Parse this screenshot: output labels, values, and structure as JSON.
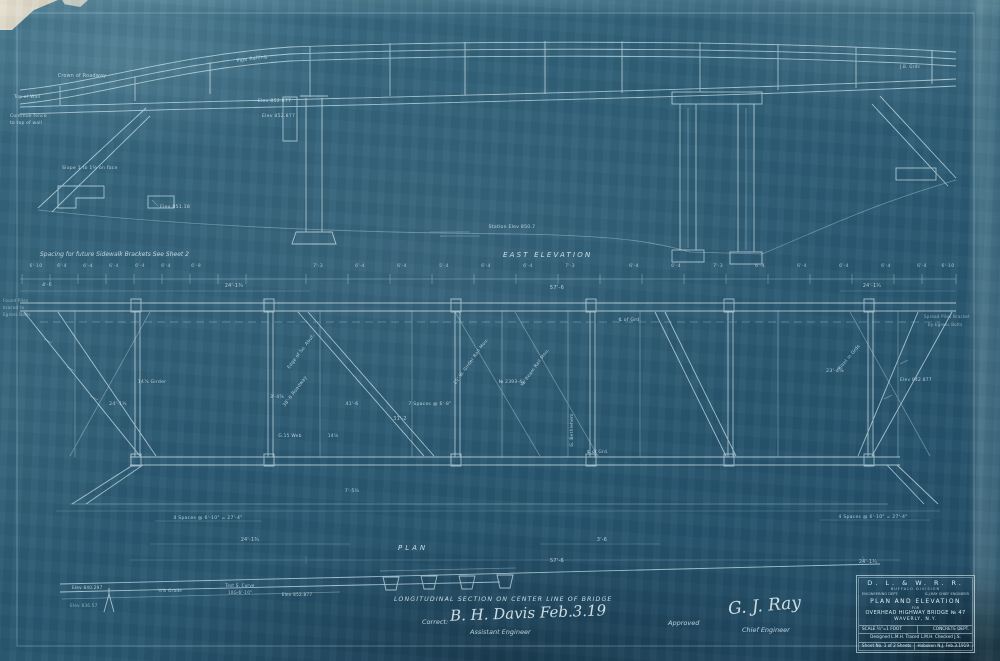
{
  "sheet": {
    "headings": {
      "elevation": "EAST ELEVATION",
      "plan": "PLAN",
      "section": "LONGITUDINAL SECTION ON CENTER LINE OF BRIDGE"
    },
    "notes": {
      "sidewalk": "Spacing for future Sidewalk Brackets   See Sheet 2"
    },
    "signatures": {
      "correct_label": "Correct:",
      "correct_sig": "B. H. Davis  Feb.3.19",
      "correct_title": "Assistant Engineer",
      "approved_label": "Approved",
      "approved_sig": "G. J. Ray",
      "approved_title": "Chief Engineer"
    },
    "title_block": {
      "railroad": "D. L. & W. R. R.",
      "division": "BUFFALO DIVISION",
      "dept": "ENGINEERING DEPT.",
      "chief": "G.J.RAY CHIEF ENGINEER",
      "title1": "PLAN AND ELEVATION",
      "for_word": "FOR",
      "title2": "OVERHEAD HIGHWAY BRIDGE № 47",
      "location": "WAVERLY, N.Y.",
      "scale": "SCALE ¼\"=1 FOOT",
      "dept2": "CONCRETE DEPT.",
      "designed": "Designed L.M.H.  Traced L.M.H.  Checked J.S.",
      "sheet_no": "Sheet No. 1 of 2 Sheets",
      "place_date": "Hoboken N.J. Feb.3.1919"
    },
    "colors": {
      "paper": "#2b5a73",
      "line": "#d6edf3"
    }
  },
  "labels": [
    {
      "x": 82,
      "y": 77,
      "t": "Crown of Roadway",
      "s": 4.8
    },
    {
      "x": 252,
      "y": 60,
      "t": "Pipe Railing",
      "s": 4.8,
      "r": -8
    },
    {
      "x": 910,
      "y": 68,
      "t": "J.B. Grds",
      "s": 4.2
    },
    {
      "x": 14,
      "y": 98,
      "t": "Top of Wall",
      "s": 4.4,
      "a": "start"
    },
    {
      "x": 10,
      "y": 117,
      "t": "Continue fence",
      "s": 4.4,
      "a": "start"
    },
    {
      "x": 10,
      "y": 124,
      "t": "to top of wall",
      "s": 4.4,
      "a": "start"
    },
    {
      "x": 258,
      "y": 102,
      "t": "Elev 852.877",
      "s": 4.6,
      "a": "start"
    },
    {
      "x": 262,
      "y": 117,
      "t": "Elev 852.877",
      "s": 4.6,
      "a": "start"
    },
    {
      "x": 62,
      "y": 169,
      "t": "Slope 1 to 1½ on face",
      "s": 4.6,
      "a": "start"
    },
    {
      "x": 160,
      "y": 208,
      "t": "Elev 851.18",
      "s": 4.6,
      "a": "start"
    },
    {
      "x": 512,
      "y": 228,
      "t": "Station Elev 850.7",
      "s": 4.6
    },
    {
      "x": 36,
      "y": 267,
      "t": "6'-10",
      "s": 4.6,
      "o": 0.7
    },
    {
      "x": 62,
      "y": 267,
      "t": "6'-4",
      "s": 4.6,
      "o": 0.7
    },
    {
      "x": 88,
      "y": 267,
      "t": "6'-4",
      "s": 4.6,
      "o": 0.7
    },
    {
      "x": 114,
      "y": 267,
      "t": "6'-4",
      "s": 4.6,
      "o": 0.7
    },
    {
      "x": 140,
      "y": 267,
      "t": "6'-4",
      "s": 4.6,
      "o": 0.7
    },
    {
      "x": 166,
      "y": 267,
      "t": "6'-4",
      "s": 4.6,
      "o": 0.7
    },
    {
      "x": 196,
      "y": 267,
      "t": "6'-9",
      "s": 4.6,
      "o": 0.7
    },
    {
      "x": 318,
      "y": 267,
      "t": "7'-3",
      "s": 4.6,
      "o": 0.7
    },
    {
      "x": 360,
      "y": 267,
      "t": "6'-4",
      "s": 4.6,
      "o": 0.7
    },
    {
      "x": 402,
      "y": 267,
      "t": "6'-4",
      "s": 4.6,
      "o": 0.7
    },
    {
      "x": 444,
      "y": 267,
      "t": "5'-4",
      "s": 4.6,
      "o": 0.7
    },
    {
      "x": 486,
      "y": 267,
      "t": "6'-4",
      "s": 4.6,
      "o": 0.7
    },
    {
      "x": 528,
      "y": 267,
      "t": "6'-4",
      "s": 4.6,
      "o": 0.7
    },
    {
      "x": 570,
      "y": 267,
      "t": "7'-3",
      "s": 4.6,
      "o": 0.7
    },
    {
      "x": 634,
      "y": 267,
      "t": "6'-4",
      "s": 4.6,
      "o": 0.7
    },
    {
      "x": 676,
      "y": 267,
      "t": "6'-4",
      "s": 4.6,
      "o": 0.7
    },
    {
      "x": 718,
      "y": 267,
      "t": "7'-3",
      "s": 4.6,
      "o": 0.7
    },
    {
      "x": 760,
      "y": 267,
      "t": "6'-4",
      "s": 4.6,
      "o": 0.7
    },
    {
      "x": 802,
      "y": 267,
      "t": "6'-4",
      "s": 4.6,
      "o": 0.7
    },
    {
      "x": 844,
      "y": 267,
      "t": "6'-4",
      "s": 4.6,
      "o": 0.7
    },
    {
      "x": 886,
      "y": 267,
      "t": "6'-4",
      "s": 4.6,
      "o": 0.7
    },
    {
      "x": 922,
      "y": 267,
      "t": "6'-4",
      "s": 4.6,
      "o": 0.7
    },
    {
      "x": 948,
      "y": 267,
      "t": "6'-10",
      "s": 4.6,
      "o": 0.7
    },
    {
      "x": 47,
      "y": 286,
      "t": "4'-6",
      "s": 4.6
    },
    {
      "x": 234,
      "y": 287,
      "t": "24'-1¾",
      "s": 4.8
    },
    {
      "x": 557,
      "y": 289,
      "t": "57'-6",
      "s": 5.2
    },
    {
      "x": 872,
      "y": 287,
      "t": "24'-1¾",
      "s": 4.8
    },
    {
      "x": 3,
      "y": 302,
      "t": "Found Piles",
      "s": 4,
      "a": "start",
      "o": 0.55
    },
    {
      "x": 3,
      "y": 309,
      "t": "braced to",
      "s": 4,
      "a": "start",
      "o": 0.55
    },
    {
      "x": 3,
      "y": 316,
      "t": "Egress Bolts",
      "s": 4,
      "a": "start",
      "o": 0.55
    },
    {
      "x": 924,
      "y": 318,
      "t": "Spread Piles Bracket",
      "s": 4,
      "a": "start",
      "o": 0.6
    },
    {
      "x": 928,
      "y": 326,
      "t": "by Egress Bolts",
      "s": 4,
      "a": "start",
      "o": 0.6
    },
    {
      "x": 630,
      "y": 321,
      "t": "℄ of Grd.",
      "s": 4.6
    },
    {
      "x": 118,
      "y": 405,
      "t": "24'-1¾",
      "s": 4.6
    },
    {
      "x": 152,
      "y": 383,
      "t": "14⅞ Girder",
      "s": 4.6
    },
    {
      "x": 296,
      "y": 392,
      "t": "38'-6 Roadway",
      "s": 4.6,
      "r": -53
    },
    {
      "x": 277,
      "y": 398,
      "t": "3'-4⅞",
      "s": 4.4
    },
    {
      "x": 352,
      "y": 405,
      "t": "41'-6",
      "s": 4.6
    },
    {
      "x": 430,
      "y": 405,
      "t": "7 Spaces @ 6'-8\"",
      "s": 4.6
    },
    {
      "x": 400,
      "y": 420,
      "t": "31'-2",
      "s": 4.8
    },
    {
      "x": 290,
      "y": 437,
      "t": "G.15 Web",
      "s": 4.4
    },
    {
      "x": 333,
      "y": 437,
      "t": "14⅞",
      "s": 4.4
    },
    {
      "x": 512,
      "y": 383,
      "t": "№ 2393-43",
      "s": 4.4
    },
    {
      "x": 835,
      "y": 372,
      "t": "23'-4⅞",
      "s": 4.6
    },
    {
      "x": 900,
      "y": 381,
      "t": "Elev 842.877",
      "s": 4.4,
      "a": "start"
    },
    {
      "x": 302,
      "y": 352,
      "t": "Edge of So. Abut.",
      "s": 4.4,
      "r": -53
    },
    {
      "x": 472,
      "y": 362,
      "t": "25' W. Girder Rail Mou.",
      "s": 4.4,
      "r": -54
    },
    {
      "x": 536,
      "y": 368,
      "t": "W. Beam Rail Mou.",
      "s": 4.4,
      "r": -54
    },
    {
      "x": 573,
      "y": 430,
      "t": "G. Bethlehem",
      "s": 4.4,
      "r": -90
    },
    {
      "x": 850,
      "y": 358,
      "t": "Rivet in Grds",
      "s": 4.4,
      "r": -50
    },
    {
      "x": 598,
      "y": 453,
      "t": "℄ of Grd.",
      "s": 4.4
    },
    {
      "x": 352,
      "y": 492,
      "t": "7'-5¼",
      "s": 4.6
    },
    {
      "x": 208,
      "y": 519,
      "t": "4 Spaces @ 6'-10\" = 27'-4\"",
      "s": 4.6
    },
    {
      "x": 873,
      "y": 518,
      "t": "4 Spaces @ 6'-10\" = 27'-4\"",
      "s": 4.6
    },
    {
      "x": 250,
      "y": 541,
      "t": "24'-1¾",
      "s": 4.8
    },
    {
      "x": 602,
      "y": 541,
      "t": "3'-6",
      "s": 4.8
    },
    {
      "x": 557,
      "y": 562,
      "t": "57'-6",
      "s": 5
    },
    {
      "x": 868,
      "y": 563,
      "t": "24'-1¾",
      "s": 4.8
    },
    {
      "x": 72,
      "y": 589,
      "t": "Elev 840.297",
      "s": 4.2,
      "a": "start"
    },
    {
      "x": 170,
      "y": 592,
      "t": "½% Grade",
      "s": 4.2
    },
    {
      "x": 240,
      "y": 587,
      "t": "Test S. Curve",
      "s": 4
    },
    {
      "x": 240,
      "y": 594,
      "t": "10G-6'-10\"",
      "s": 4
    },
    {
      "x": 297,
      "y": 596,
      "t": "Elev 852.877",
      "s": 4.2
    },
    {
      "x": 70,
      "y": 607,
      "t": "Elev 836.57",
      "s": 4.2,
      "a": "start",
      "o": 0.6
    }
  ]
}
